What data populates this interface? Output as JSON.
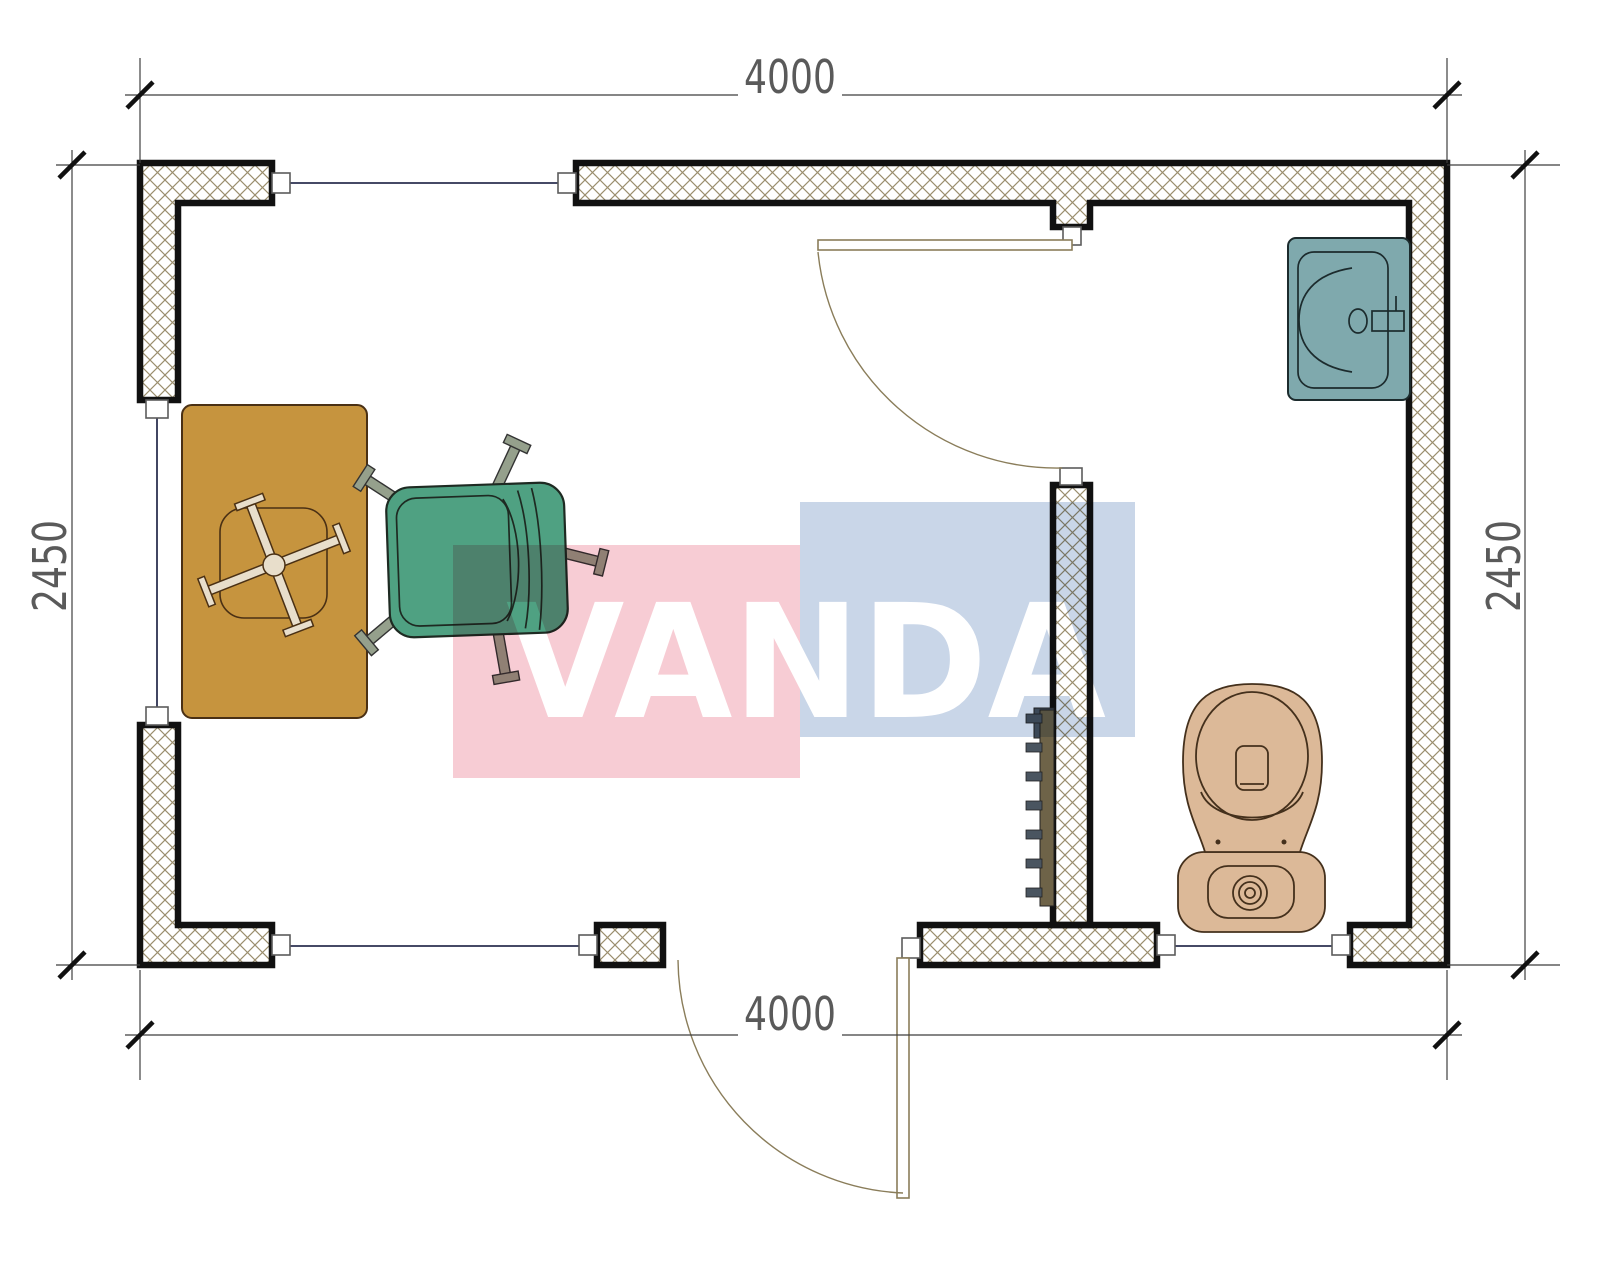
{
  "page": {
    "type": "architectural-floor-plan"
  },
  "dimensions": {
    "top": "4000",
    "bottom": "4000",
    "left": "2450",
    "right": "2450"
  },
  "watermark": {
    "text": "VANDA",
    "pink_block_color": "#f7ccd4",
    "blue_block_color": "#c9d6e8",
    "text_color": "#ffffff"
  },
  "plan": {
    "wall_hatch_color": "#9b8e6e",
    "wall_outline_color": "#111111",
    "window_glazing_color": "#2c3150",
    "door_symbol_color": "#8a7d5a",
    "fixtures": [
      {
        "name": "desk",
        "color": "#c6943e"
      },
      {
        "name": "office-chair",
        "color": "#4fa182"
      },
      {
        "name": "sink",
        "color": "#7fa9ad"
      },
      {
        "name": "toilet",
        "color": "#dcb998"
      },
      {
        "name": "radiator",
        "color": "#6e6348"
      }
    ]
  }
}
